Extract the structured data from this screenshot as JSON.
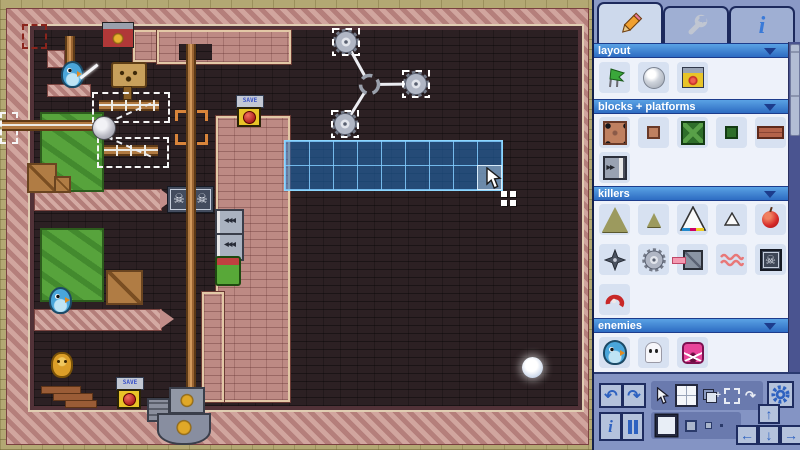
{
  "app": {
    "name": "pixel platformer level editor",
    "screen": "edit mode"
  },
  "canvas": {
    "save_sign_text": "SAVE",
    "selection_grid": {
      "cols": 9,
      "rows": 2,
      "tile_px": 24,
      "fill_color": "#2070be",
      "line_color": "#82cdff"
    },
    "colors": {
      "outer_bricks": "#b3a873",
      "border_bricks": "#c28e8a",
      "interior": "#2c2023",
      "pool_green": "#57a33c",
      "pole_brown": "#b07a42",
      "selection_white_dash": "#f6f6f6",
      "target_bracket_orange": "#d8843a",
      "save_button_yellow": "#e8c428",
      "save_button_red": "#d83434"
    },
    "objects": [
      "screen-boundary-marker (red dashed, top-left border)",
      "bird-enemy on platform with sword effect (top-left)",
      "red-banner-dispenser (top)",
      "wooden-face-sign (top)",
      "rail-assembly: horizontal rail + ball joint + 3 dashed selection boxes + 2 dashed ropes",
      "acid-pool upper",
      "acid-pool lower",
      "crate large / crate small (room 1)",
      "crate (room 2)",
      "crate? bird (room 2)",
      "platform-bar with pointed tip (x2 room dividers)",
      "skull-block pair",
      "conveyor-stack (left arrows)",
      "green-barrel with red lid",
      "vertical-pole with orange target bracket",
      "SAVE sign + button (upper)",
      "rotating-saw-assembly: hub + 3 saw blades each in dashed selection",
      "blue tile selection grid 9x2 with cursor and grid icon",
      "gold-creature (bottom-left)",
      "brick-steps x3",
      "SAVE sign + button (lower)",
      "pole-base-machine with gold emblems",
      "glowing-white-ball (bottom-right)"
    ]
  },
  "panel": {
    "tabs": [
      {
        "icon": "pencil-icon",
        "active": true
      },
      {
        "icon": "wrench-icon",
        "active": false
      },
      {
        "icon": "info-icon",
        "active": false
      }
    ],
    "sections": [
      {
        "title": "layout",
        "items": [
          "flag",
          "bubble",
          "save-button"
        ]
      },
      {
        "title": "blocks + platforms",
        "items": [
          "block-large-selected",
          "block-small",
          "green-block-large",
          "green-block-small",
          "brick-platform",
          "conveyor-block"
        ]
      },
      {
        "title": "killers",
        "items": [
          "spike-large",
          "spike-small",
          "spike-outline-large",
          "spike-outline-small",
          "apple",
          "shuriken-star",
          "saw-blade",
          "laser-block",
          "squiggle-worms",
          "skull-block",
          "red-swirl"
        ]
      },
      {
        "title": "enemies",
        "items": [
          "blue-bird",
          "ghost",
          "pink-angry-block"
        ]
      }
    ],
    "toolbar": {
      "row1": [
        "undo",
        "redo",
        "cursor-tool",
        "grid-draw-tool-active",
        "stamp-copy-tool",
        "marquee-select-tool",
        "rotate-tool",
        "settings-gear"
      ],
      "row2": [
        "info-toggle",
        "pause-toggle",
        "brush-size-large-selected",
        "brush-size-medium",
        "brush-size-small",
        "brush-size-tiny",
        "nudge-up",
        "nudge-left",
        "nudge-down",
        "nudge-right"
      ]
    },
    "colors": {
      "header_blue": "#3f85d6",
      "panel_bg": "#8a99c6",
      "body_bg": "#eef2fa",
      "item_bg": "#d7e1f1",
      "icon_blue": "#2e62c0"
    }
  }
}
